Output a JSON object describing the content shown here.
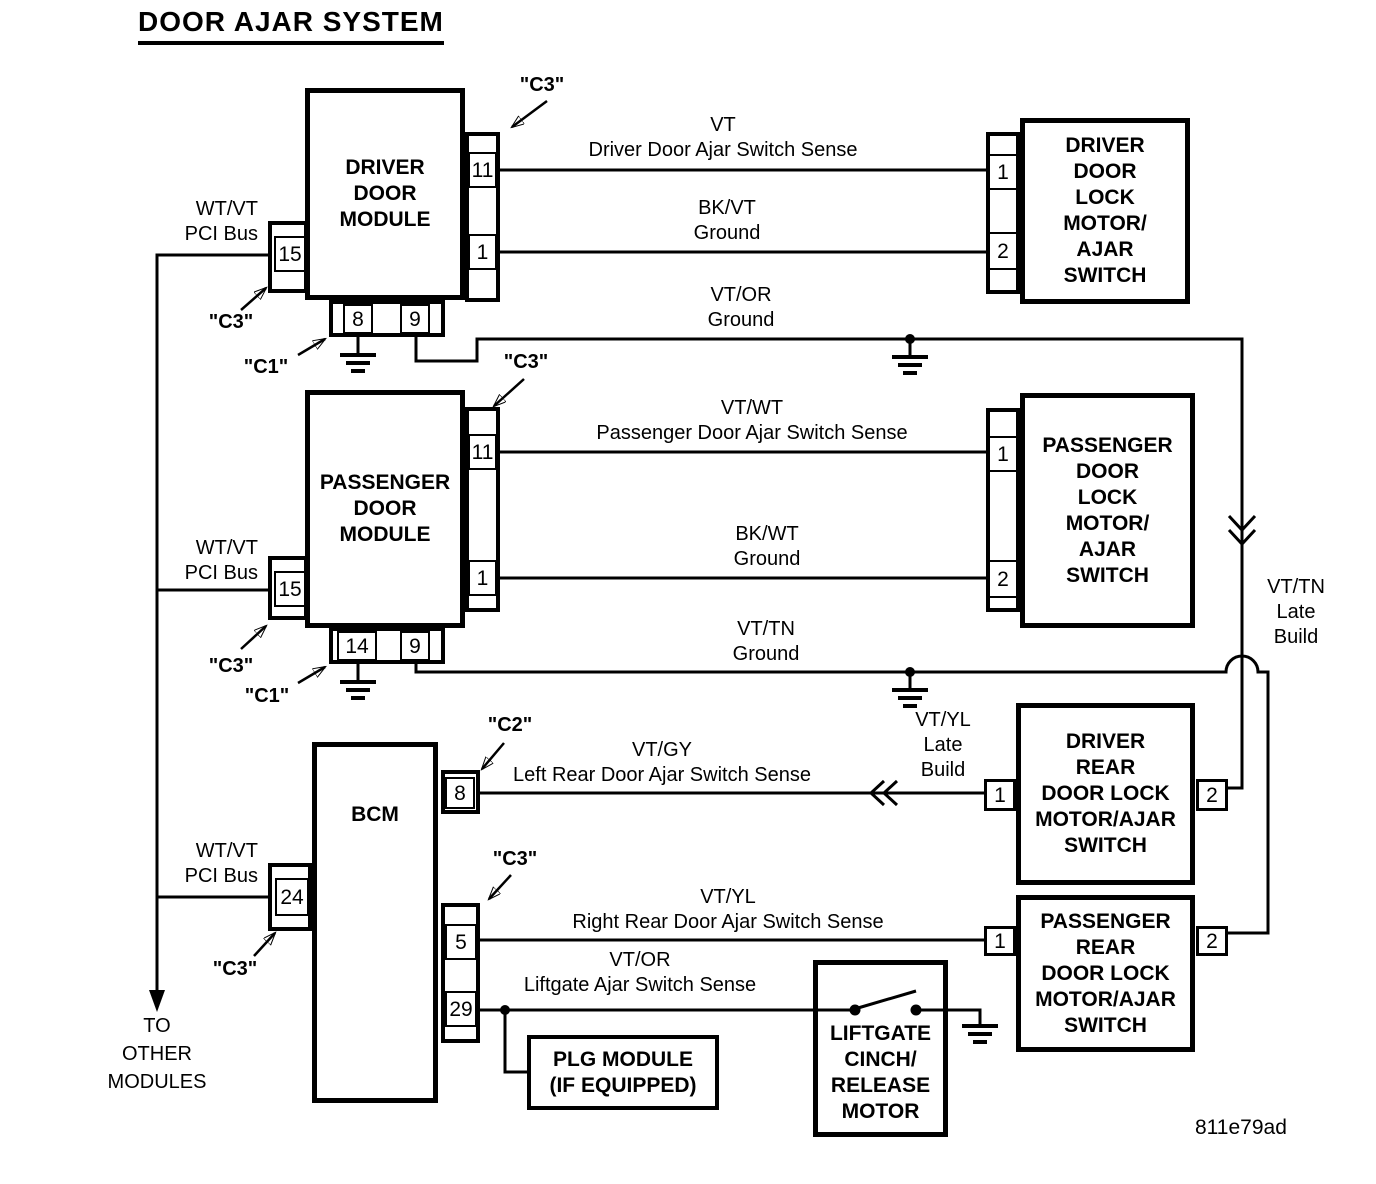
{
  "title": "DOOR AJAR SYSTEM",
  "part_number": "811e79ad",
  "colors": {
    "ink": "#000000",
    "background": "#ffffff"
  },
  "modules": {
    "driver_door_module": {
      "label": "DRIVER\nDOOR\nMODULE",
      "pins": {
        "p11": "11",
        "p1": "1",
        "p15": "15",
        "p8": "8",
        "p9": "9"
      }
    },
    "passenger_door_module": {
      "label": "PASSENGER\nDOOR\nMODULE",
      "pins": {
        "p11": "11",
        "p1": "1",
        "p15": "15",
        "p14": "14",
        "p9": "9"
      }
    },
    "bcm": {
      "label": "BCM",
      "pins": {
        "p8": "8",
        "p24": "24",
        "p5": "5",
        "p29": "29"
      }
    },
    "driver_door_lock": {
      "label": "DRIVER\nDOOR\nLOCK\nMOTOR/\nAJAR\nSWITCH",
      "pins": {
        "p1": "1",
        "p2": "2"
      }
    },
    "passenger_door_lock": {
      "label": "PASSENGER\nDOOR\nLOCK\nMOTOR/\nAJAR\nSWITCH",
      "pins": {
        "p1": "1",
        "p2": "2"
      }
    },
    "driver_rear_door_lock": {
      "label": "DRIVER\nREAR\nDOOR LOCK\nMOTOR/AJAR\nSWITCH",
      "pins": {
        "p1": "1",
        "p2": "2"
      }
    },
    "passenger_rear_door_lock": {
      "label": "PASSENGER\nREAR\nDOOR LOCK\nMOTOR/AJAR\nSWITCH",
      "pins": {
        "p1": "1",
        "p2": "2"
      }
    },
    "plg_module": {
      "label": "PLG MODULE\n(IF EQUIPPED)"
    },
    "liftgate_motor": {
      "label": "LIFTGATE\nCINCH/\nRELEASE\nMOTOR"
    }
  },
  "wires": {
    "driver_ajar": "VT\nDriver Door Ajar Switch Sense",
    "driver_ground": "BK/VT\nGround",
    "vt_or_ground": "VT/OR\nGround",
    "passenger_ajar": "VT/WT\nPassenger Door Ajar Switch Sense",
    "passenger_ground": "BK/WT\nGround",
    "vt_tn_ground": "VT/TN\nGround",
    "left_rear_ajar": "VT/GY\nLeft Rear Door Ajar Switch Sense",
    "right_rear_ajar": "VT/YL\nRight Rear Door Ajar Switch Sense",
    "liftgate_ajar": "VT/OR\nLiftgate Ajar Switch Sense"
  },
  "bus_label": "WT/VT\nPCI Bus",
  "late_build": {
    "vt_yl": "VT/YL\nLate\nBuild",
    "vt_tn": "VT/TN\nLate\nBuild"
  },
  "connector_labels": {
    "c1": "\"C1\"",
    "c2": "\"C2\"",
    "c3": "\"C3\""
  },
  "footer_note": "TO\nOTHER\nMODULES"
}
